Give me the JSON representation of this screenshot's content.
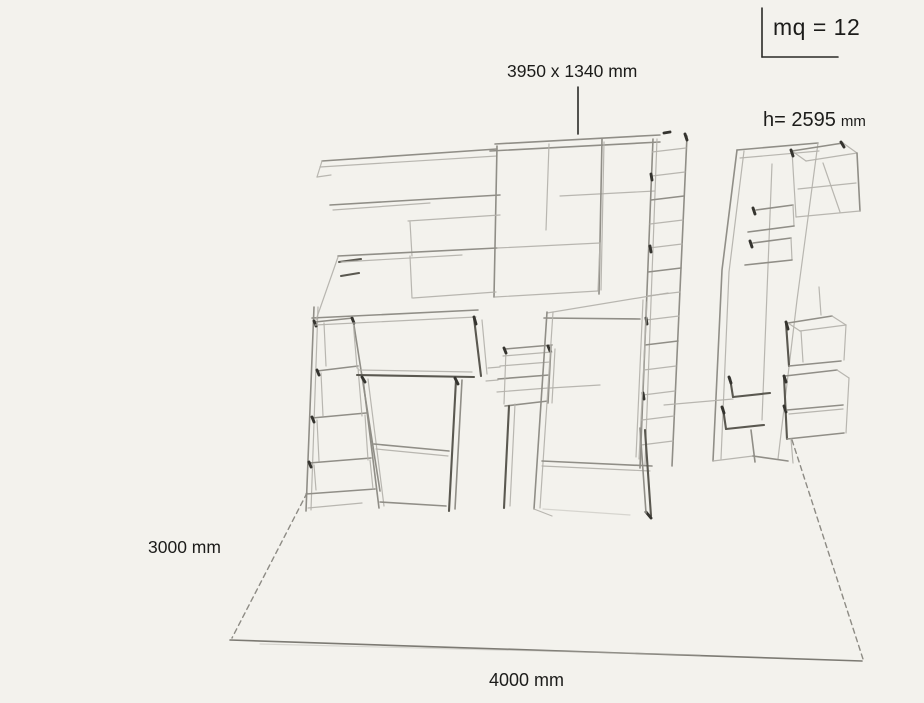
{
  "canvas": {
    "background": "#f3f2ed",
    "pencil_line_color": "#8d8b84",
    "text_color": "#1c1c1a"
  },
  "labels": {
    "area": "mq = 12",
    "wall_unit_size": "3950 x 1340 mm",
    "height": "h= 2595",
    "height_unit": "mm",
    "room_depth": "3000 mm",
    "room_width": "4000 mm"
  }
}
